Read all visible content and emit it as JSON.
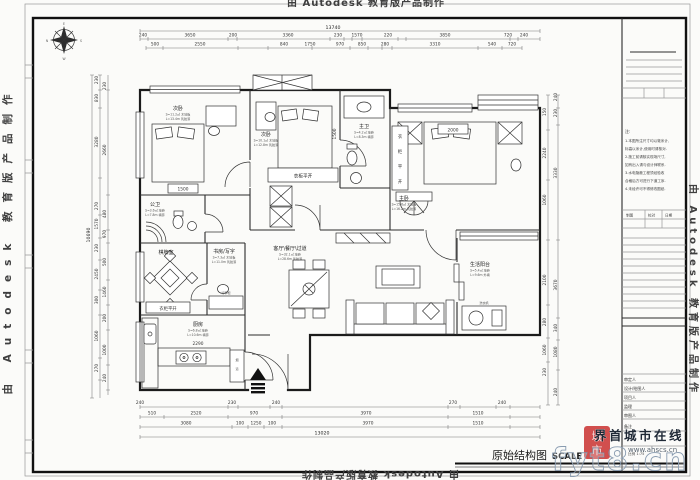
{
  "watermarks": {
    "autodesk": "由 Autodesk 教育版产品制作",
    "site_name": "界首城市在线",
    "site_url": "www.ahscs.cn",
    "overlay": "fyt8.cn",
    "seal_char1": "城",
    "seal_char2": "市"
  },
  "sheet": {
    "title": "原始结构图",
    "scale_label": "SCALE",
    "scale_row": "比例 1:75"
  },
  "compass": {
    "top": "E",
    "right": "S",
    "bottom": "W",
    "left": "N"
  },
  "rooms": {
    "bedroom1": {
      "name": "次卧",
      "line1": "S=11.2㎡ 木地板",
      "line2": "L=13.4m 乳胶漆",
      "dim": "1500"
    },
    "bedroom2": {
      "name": "次卧",
      "line1": "S=10.1㎡ 木地板",
      "line2": "L=12.8m 乳胶漆",
      "dim": "1500"
    },
    "master": {
      "name": "主卧",
      "line1": "S=15.6㎡ 木地板",
      "line2": "L=16.2m 乳胶漆",
      "dim": "2000"
    },
    "bath_master": {
      "name": "主卫",
      "line1": "S=4.2㎡ 地砖",
      "line2": "L=8.3m 墙砖"
    },
    "bath_public": {
      "name": "公卫",
      "line1": "S=3.6㎡ 地砖",
      "line2": "L=7.8m 墙砖"
    },
    "mahjong": {
      "name": "棋牌室"
    },
    "study": {
      "name": "书房/写字",
      "line1": "S=7.3㎡ 木地板",
      "line2": "L=11.0m 乳胶漆"
    },
    "kitchen": {
      "name": "厨房",
      "line1": "S=6.8㎡ 地砖",
      "line2": "L=10.6m 墙砖",
      "dim": "2290"
    },
    "living": {
      "name": "客厅\\餐厅\\过道",
      "line1": "S=32.1㎡ 地砖",
      "line2": "L=28.6m 乳胶漆"
    },
    "balcony": {
      "name": "生活阳台",
      "line1": "S=5.4㎡ 地砖",
      "line2": "L=9.6m 外墙"
    },
    "wardrobe_label": "衣柜平开",
    "wardrobe_chars": [
      "衣",
      "柜",
      "平",
      "开"
    ],
    "flue_chars": [
      "烟",
      "道"
    ],
    "washer": "洗衣机",
    "luggage": "行李柜"
  },
  "dims": {
    "top_total": "13740",
    "top1": [
      "240",
      "3650",
      "200",
      "3360",
      "230",
      "1570",
      "220",
      "3850",
      "720",
      "240"
    ],
    "top2": [
      "500",
      "2550",
      "840",
      "1750",
      "970",
      "850",
      "280",
      "3310",
      "540",
      "720"
    ],
    "left_total": "10690",
    "left1": [
      "230",
      "830",
      "3280",
      "270",
      "1570",
      "230",
      "2450",
      "300",
      "1060",
      "270"
    ],
    "left2": [
      "230",
      "2660",
      "480",
      "970",
      "500",
      "1460",
      "200",
      "1000",
      "240"
    ],
    "right1": [
      "150",
      "2240",
      "1060",
      "2100",
      "280",
      "1060",
      "230"
    ],
    "right2": [
      "240",
      "230",
      "3330",
      "3670",
      "340",
      "1080",
      "240"
    ],
    "bottom1": [
      "240",
      "230",
      "240",
      "270",
      "240"
    ],
    "bottom2": [
      "510",
      "2520",
      "970",
      "3970",
      "1510"
    ],
    "bottom3": [
      "3080",
      "100",
      "1250",
      "100",
      "3970",
      "1510"
    ],
    "bottom_total": "13020"
  },
  "titleblock": {
    "notes_label": "注:",
    "notes": [
      "1.本图所注尺寸均以毫米计,",
      "标高以米计,使用时请核对.",
      "2.施工前请核实现场尺寸,",
      "如有出入请与设计师联系.",
      "3.水电隐蔽工程须经验收",
      "合格后方可进行下道工序.",
      "4.未经许可不得修改图纸."
    ],
    "mini_table": [
      "制图",
      "校对",
      "日期"
    ],
    "fields": [
      "审定人",
      "设计/绘图人",
      "项目人",
      "监理",
      "审图人",
      "备注"
    ]
  }
}
